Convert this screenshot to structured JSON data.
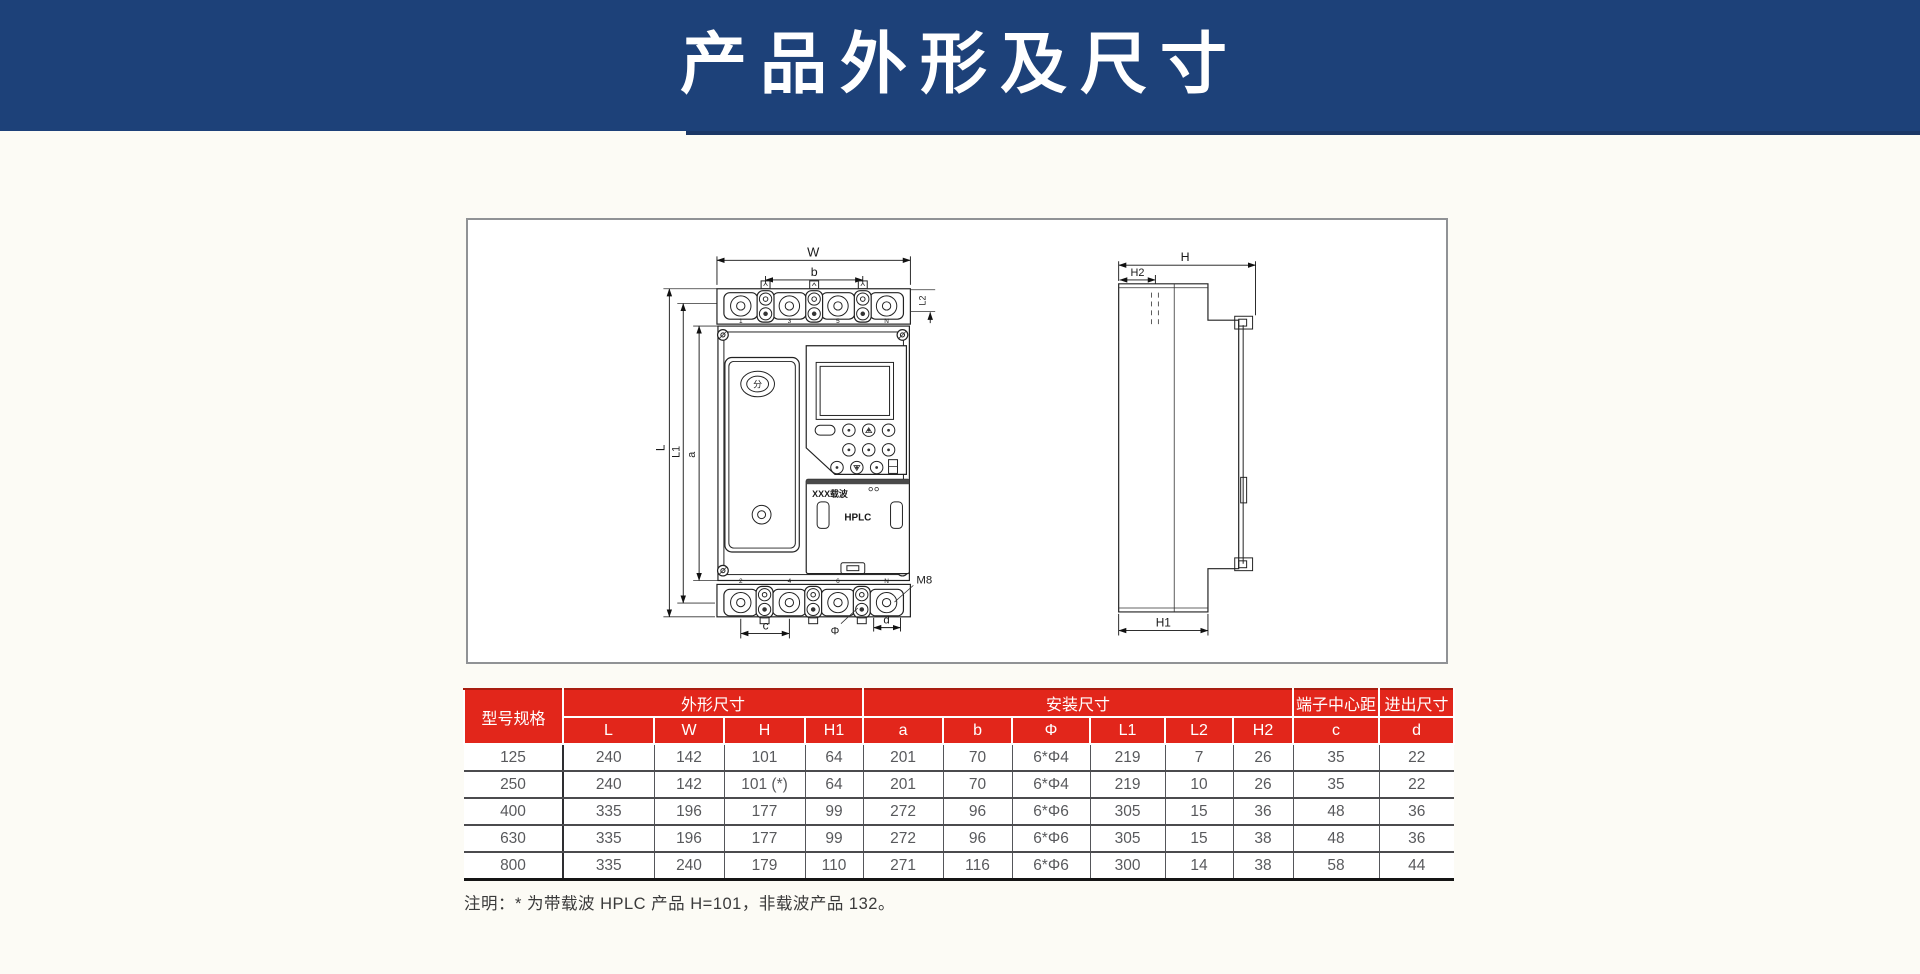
{
  "page": {
    "title": "产品外形及尺寸"
  },
  "colors": {
    "banner_bg": "#1d4179",
    "banner_accent": "#1b3766",
    "table_header_bg": "#e2261b",
    "table_header_text": "#ffffff",
    "table_body_text": "#58595c"
  },
  "drawing": {
    "front": {
      "width_label": "W",
      "b_label": "b",
      "l2_label": "L2",
      "l_label": "L",
      "l1_label": "L1",
      "a_label": "a",
      "c_label": "c",
      "phi_label": "Φ",
      "d_label": "d",
      "m8_label": "M8",
      "top_terminals": [
        "1",
        "3",
        "5",
        "N"
      ],
      "bottom_terminals": [
        "2",
        "4",
        "6",
        "N"
      ],
      "button_label": "分",
      "module_brand": "XXX载波",
      "module_name": "HPLC"
    },
    "side": {
      "h_label": "H",
      "h1_label": "H1",
      "h2_label": "H2"
    }
  },
  "table": {
    "col_model": "型号规格",
    "group_shape": "外形尺寸",
    "group_mount": "安装尺寸",
    "group_terminal": "端子中心距",
    "group_inout": "进出尺寸",
    "sub_headers": [
      "L",
      "W",
      "H",
      "H1",
      "a",
      "b",
      "Φ",
      "L1",
      "L2",
      "H2",
      "c",
      "d"
    ],
    "rows": [
      [
        "125",
        "240",
        "142",
        "101",
        "64",
        "201",
        "70",
        "6*Φ4",
        "219",
        "7",
        "26",
        "35",
        "22"
      ],
      [
        "250",
        "240",
        "142",
        "101 (*)",
        "64",
        "201",
        "70",
        "6*Φ4",
        "219",
        "10",
        "26",
        "35",
        "22"
      ],
      [
        "400",
        "335",
        "196",
        "177",
        "99",
        "272",
        "96",
        "6*Φ6",
        "305",
        "15",
        "36",
        "48",
        "36"
      ],
      [
        "630",
        "335",
        "196",
        "177",
        "99",
        "272",
        "96",
        "6*Φ6",
        "305",
        "15",
        "38",
        "48",
        "36"
      ],
      [
        "800",
        "335",
        "240",
        "179",
        "110",
        "271",
        "116",
        "6*Φ6",
        "300",
        "14",
        "38",
        "58",
        "44"
      ]
    ],
    "note": "注明：* 为带载波 HPLC 产品 H=101，非载波产品 132。"
  }
}
